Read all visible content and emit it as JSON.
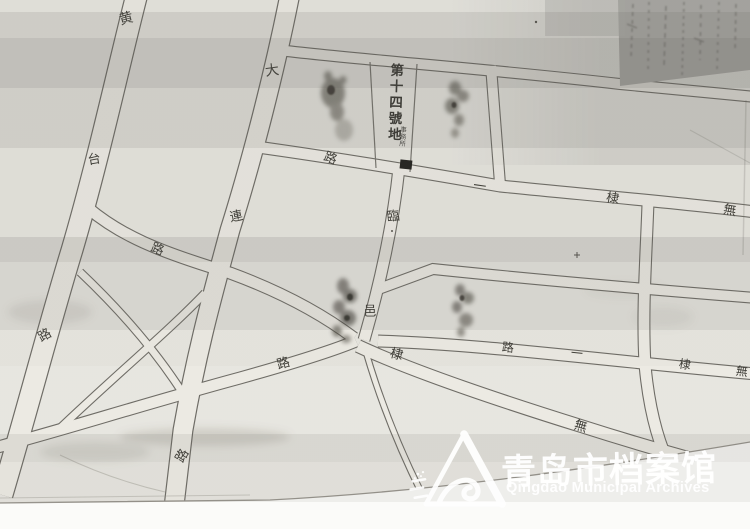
{
  "map": {
    "district_label": {
      "text": "第十四號地"
    },
    "building_annotation": {
      "text": "事務所",
      "marker": "filled-black-rectangle"
    },
    "street_names_implied": [
      "黄台路",
      "大連路",
      "臨邑路",
      "無棣一路"
    ],
    "street_char_labels": [
      {
        "ch": "黄",
        "x": 126,
        "y": 18,
        "r": -15,
        "s": 14
      },
      {
        "ch": "台",
        "x": 94,
        "y": 158,
        "r": -10,
        "s": 13
      },
      {
        "ch": "路",
        "x": 44,
        "y": 334,
        "r": -30,
        "s": 13
      },
      {
        "ch": "大",
        "x": 272,
        "y": 70,
        "r": -8,
        "s": 14
      },
      {
        "ch": "連",
        "x": 236,
        "y": 215,
        "r": -12,
        "s": 13
      },
      {
        "ch": "路",
        "x": 181,
        "y": 455,
        "r": -60,
        "s": 13
      },
      {
        "ch": "路",
        "x": 158,
        "y": 248,
        "r": 22,
        "s": 13
      },
      {
        "ch": "路",
        "x": 331,
        "y": 157,
        "r": 22,
        "s": 13
      },
      {
        "ch": "一",
        "x": 480,
        "y": 185,
        "r": 8,
        "s": 13
      },
      {
        "ch": "棣",
        "x": 613,
        "y": 197,
        "r": 10,
        "s": 13
      },
      {
        "ch": "無",
        "x": 730,
        "y": 209,
        "r": 10,
        "s": 13
      },
      {
        "ch": "臨",
        "x": 393,
        "y": 215,
        "r": -6,
        "s": 13
      },
      {
        "ch": "邑",
        "x": 370,
        "y": 310,
        "r": 0,
        "s": 13
      },
      {
        "ch": "路",
        "x": 283,
        "y": 362,
        "r": -16,
        "s": 13
      },
      {
        "ch": "棣",
        "x": 397,
        "y": 353,
        "r": 14,
        "s": 13
      },
      {
        "ch": "無",
        "x": 581,
        "y": 425,
        "r": 16,
        "s": 13
      },
      {
        "ch": "路",
        "x": 508,
        "y": 347,
        "r": 6,
        "s": 12
      },
      {
        "ch": "一",
        "x": 577,
        "y": 353,
        "r": 6,
        "s": 12
      },
      {
        "ch": "棣",
        "x": 685,
        "y": 364,
        "r": 8,
        "s": 12
      },
      {
        "ch": "無",
        "x": 742,
        "y": 371,
        "r": 8,
        "s": 12
      }
    ],
    "handwritten_note": {
      "description": "illegible vertical handwriting in dark corner",
      "legible": false
    }
  },
  "watermark": {
    "org_cn": "青岛市档案馆",
    "org_en": "Qingdao Municipal Archives",
    "logo": "triangle-wave-archives-logo"
  }
}
